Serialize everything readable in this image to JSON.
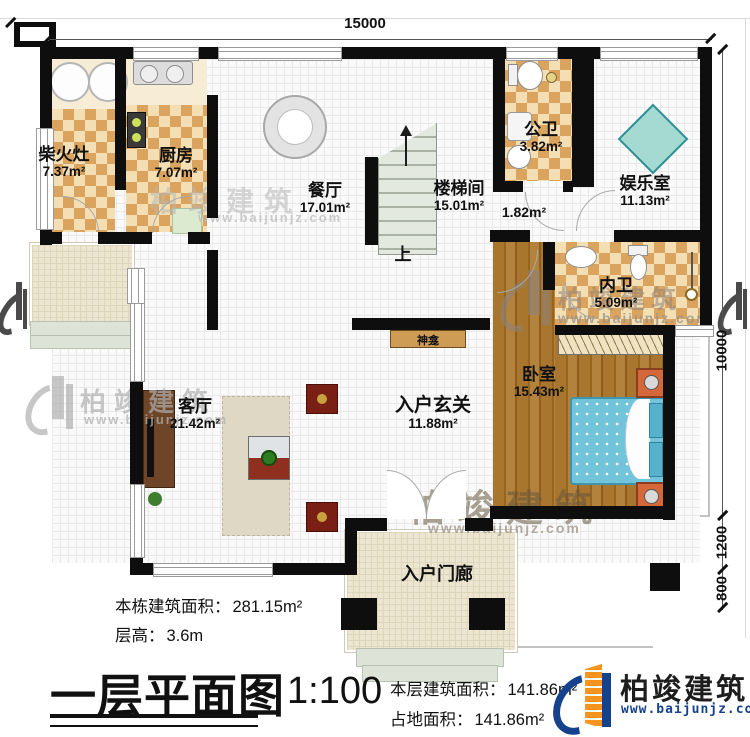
{
  "dimensions": {
    "top": "15000",
    "right_upper": "10000",
    "right_mid": "1200",
    "right_lower": "800"
  },
  "rooms": {
    "chaihuozao": {
      "name": "柴火灶",
      "area": "7.37m²"
    },
    "kitchen": {
      "name": "厨房",
      "area": "7.07m²"
    },
    "dining": {
      "name": "餐厅",
      "area": "17.01m²"
    },
    "stairwell": {
      "name": "楼梯间",
      "area": "15.01m²"
    },
    "stair_nook": {
      "area": "1.82m²"
    },
    "public_bath": {
      "name": "公卫",
      "area": "3.82m²"
    },
    "entertainment": {
      "name": "娱乐室",
      "area": "11.13m²"
    },
    "inner_bath": {
      "name": "内卫",
      "area": "5.09m²"
    },
    "bedroom": {
      "name": "卧室",
      "area": "15.43m²"
    },
    "living": {
      "name": "客厅",
      "area": "21.42m²"
    },
    "foyer": {
      "name": "入户玄关",
      "area": "11.88m²"
    },
    "entry_porch": {
      "name": "入户门廊"
    }
  },
  "labels": {
    "shrine": "神龛",
    "stairs_up": "上"
  },
  "title_block": {
    "plan_title": "一层平面图",
    "scale": "1:100",
    "total_area_label": "本栋建筑面积：",
    "total_area_value": "281.15m²",
    "floor_height_label": "层高：",
    "floor_height_value": "3.6m",
    "floor_area_label": "本层建筑面积：",
    "floor_area_value": "141.86m²",
    "footprint_label": "占地面积：",
    "footprint_value": "141.86m²"
  },
  "brand": {
    "name": "柏竣建筑",
    "website": "www.baijunjz.com"
  }
}
